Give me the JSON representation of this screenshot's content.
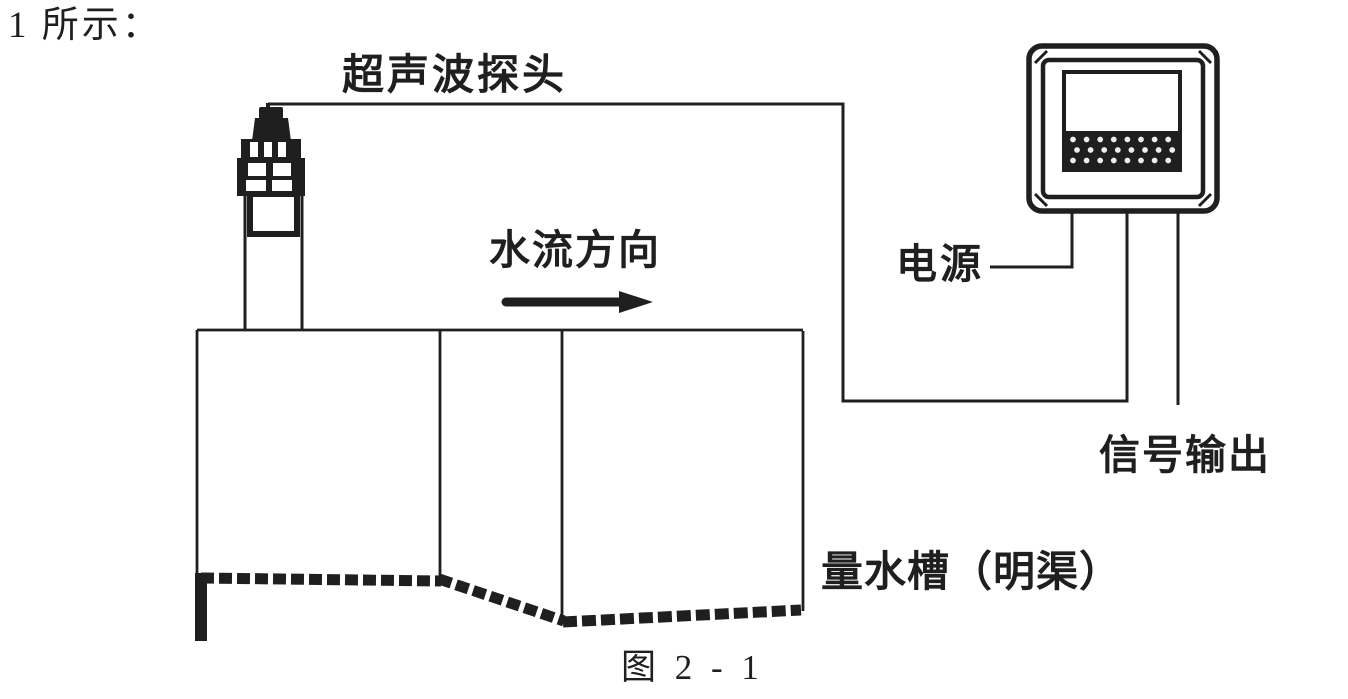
{
  "page": {
    "background_color": "#ffffff",
    "ink_color": "#1f1f1f",
    "description_tag": "ultrasonic-open-channel-flowmeter-diagram"
  },
  "intro_text": "1 所示：",
  "figure_caption": "图 2 - 1",
  "labels": {
    "probe": "超声波探头",
    "flow_direction": "水流方向",
    "power": "电源",
    "signal_output": "信号输出",
    "flume": "量水槽（明渠）"
  }
}
